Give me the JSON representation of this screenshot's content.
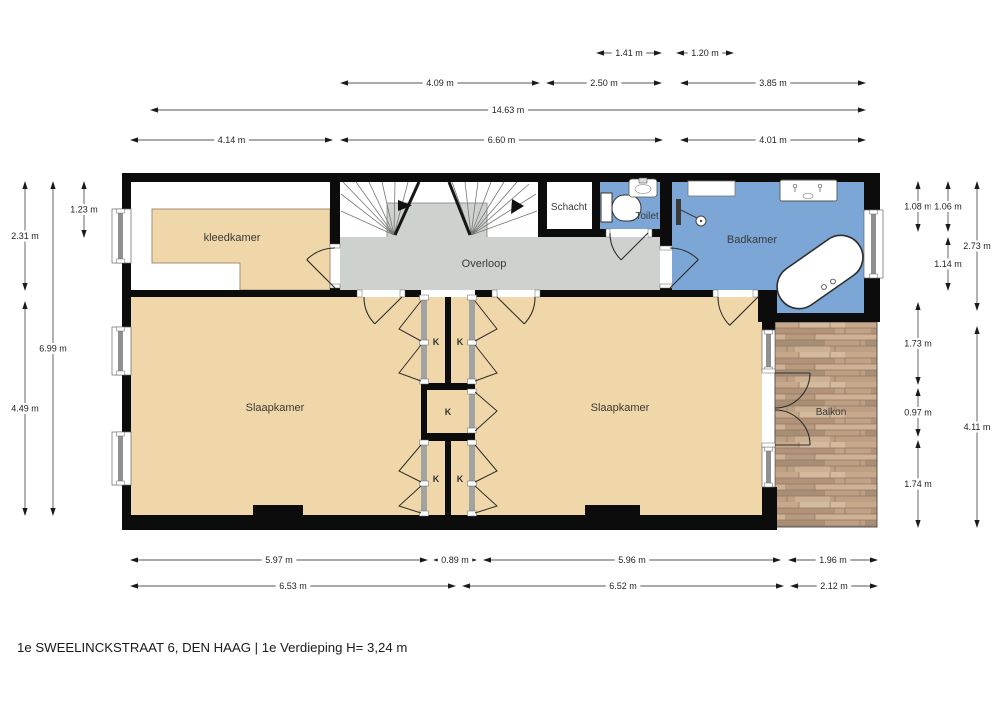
{
  "title": "1e SWEELINCKSTRAAT 6, DEN HAAG | 1e Verdieping H= 3,24 m",
  "rooms": {
    "kleedkamer": "kleedkamer",
    "overloop": "Overloop",
    "schacht": "Schacht",
    "toilet": "Toilet",
    "badkamer": "Badkamer",
    "slaapkamer_left": "Slaapkamer",
    "slaapkamer_right": "Slaapkamer",
    "balkon": "Balkon",
    "closet": "K"
  },
  "colors": {
    "wall": "#0c0c0c",
    "bedroom_fill": "#EFD7A9",
    "bathroom_fill": "#7BA6D5",
    "hallway_fill": "#CDD2CE",
    "balcony_wood": "#C2A284",
    "window_frame": "#909090",
    "dimension_line": "#555555",
    "label_text": "#3A3A3A"
  },
  "dimensions": {
    "horizontal": [
      {
        "label": "1.41 m",
        "x1": 596,
        "x2": 662,
        "y": 53
      },
      {
        "label": "1.20 m",
        "x1": 676,
        "x2": 734,
        "y": 53
      },
      {
        "label": "4.09 m",
        "x1": 340,
        "x2": 540,
        "y": 83
      },
      {
        "label": "2.50 m",
        "x1": 546,
        "x2": 662,
        "y": 83
      },
      {
        "label": "3.85 m",
        "x1": 680,
        "x2": 866,
        "y": 83
      },
      {
        "label": "14.63 m",
        "x1": 150,
        "x2": 866,
        "y": 110
      },
      {
        "label": "4.14 m",
        "x1": 130,
        "x2": 333,
        "y": 140
      },
      {
        "label": "6.60 m",
        "x1": 340,
        "x2": 663,
        "y": 140
      },
      {
        "label": "4.01 m",
        "x1": 680,
        "x2": 866,
        "y": 140
      },
      {
        "label": "5.97 m",
        "x1": 130,
        "x2": 428,
        "y": 560
      },
      {
        "label": "0.89 m",
        "x1": 433,
        "x2": 477,
        "y": 560
      },
      {
        "label": "5.96 m",
        "x1": 483,
        "x2": 781,
        "y": 560
      },
      {
        "label": "1.96 m",
        "x1": 788,
        "x2": 878,
        "y": 560
      },
      {
        "label": "6.53 m",
        "x1": 130,
        "x2": 456,
        "y": 586
      },
      {
        "label": "6.52 m",
        "x1": 462,
        "x2": 784,
        "y": 586
      },
      {
        "label": "2.12 m",
        "x1": 790,
        "x2": 878,
        "y": 586
      }
    ],
    "vertical": [
      {
        "label": "2.31 m",
        "x": 25,
        "y1": 181,
        "y2": 291
      },
      {
        "label": "4.49 m",
        "x": 25,
        "y1": 301,
        "y2": 516
      },
      {
        "label": "6.99 m",
        "x": 53,
        "y1": 181,
        "y2": 516
      },
      {
        "label": "1.23 m",
        "x": 84,
        "y1": 181,
        "y2": 238
      },
      {
        "label": "1.08 m",
        "x": 918,
        "y1": 181,
        "y2": 232
      },
      {
        "label": "1.73 m",
        "x": 918,
        "y1": 302,
        "y2": 385
      },
      {
        "label": "0.97 m",
        "x": 918,
        "y1": 388,
        "y2": 437
      },
      {
        "label": "1.74 m",
        "x": 918,
        "y1": 440,
        "y2": 528
      },
      {
        "label": "1.06 m",
        "x": 948,
        "y1": 181,
        "y2": 232
      },
      {
        "label": "1.14 m",
        "x": 948,
        "y1": 237,
        "y2": 291
      },
      {
        "label": "2.73 m",
        "x": 977,
        "y1": 181,
        "y2": 311
      },
      {
        "label": "4.11 m",
        "x": 977,
        "y1": 326,
        "y2": 528
      }
    ]
  }
}
